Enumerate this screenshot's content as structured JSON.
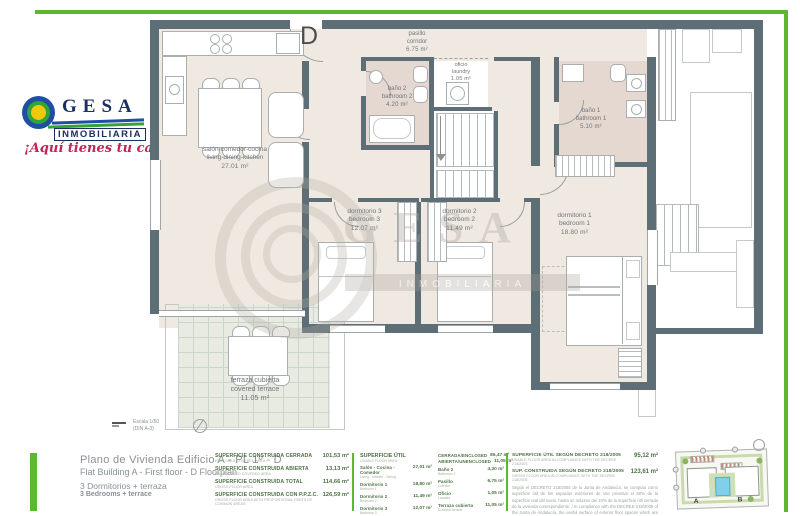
{
  "colors": {
    "green": "#5cb82e",
    "wall": "#5d6e76",
    "floor": "#efe9e1",
    "bath": "#e4d8d1",
    "navy": "#1c2f63",
    "tgreen": "#4d7245",
    "gray": "#8a9095"
  },
  "logo": {
    "name": "GESA",
    "sub": "INMOBILIARIA",
    "tagline": "¡Aquí tienes tu casa...!"
  },
  "entrance_label": "D",
  "watermark": {
    "line1": "GESA",
    "line2": "INMOBILIARIA"
  },
  "plan": {
    "rooms": [
      {
        "name_es": "salón-comedor-cocina",
        "name_en": "living-dining-kitchen",
        "area": "27.01 m²"
      },
      {
        "name_es": "pasillo",
        "name_en": "corridor",
        "area": "6.75 m²"
      },
      {
        "name_es": "oficio",
        "name_en": "laundry",
        "area": "1.05 m²"
      },
      {
        "name_es": "baño 2",
        "name_en": "bathroom 2",
        "area": "4.20 m²"
      },
      {
        "name_es": "baño 1",
        "name_en": "bathroom 1",
        "area": "5.10 m²"
      },
      {
        "name_es": "dormitorio 3",
        "name_en": "bedroom 3",
        "area": "12.07 m²"
      },
      {
        "name_es": "dormitorio 2",
        "name_en": "bedroom 2",
        "area": "11.49 m²"
      },
      {
        "name_es": "dormitorio 1",
        "name_en": "bedroom 1",
        "area": "18.80 m²"
      },
      {
        "name_es": "terraza cubierta",
        "name_en": "covered terrace",
        "area": "11.05 m²"
      }
    ],
    "scale": {
      "line1": "Escala 1/50",
      "line2": "(DIN A-3)"
    }
  },
  "title_block": {
    "line1": "Plano de Vivienda Edificio A - PL 1º - D",
    "line2": "Flat Building A - First floor - D  Floorplan",
    "line3": "3 Dormitorios + terraza",
    "line4": "3 Bedrooms + terrace"
  },
  "areas": {
    "built": [
      {
        "es": "SUPERFICIE CONSTRUIDA CERRADA",
        "en": "ENCLOSED COVERED AREA",
        "value": "101,53 m²"
      },
      {
        "es": "SUPERFICIE CONSTRUIDA ABIERTA",
        "en": "UNENCLOSED COVERED AREA",
        "value": "13,13 m²"
      },
      {
        "es": "SUPERFICIE CONSTRUIDA TOTAL",
        "en": "GROSS FLOOR AREA",
        "value": "114,66 m²"
      },
      {
        "es": "SUPERFICIE CONSTRUIDA CON P.P.Z.C.",
        "en": "GROSS FLOOR AREA WITH PROPORTIONAL PARTS OF COMMON AREAS",
        "value": "126,59 m²"
      }
    ],
    "useful": {
      "header_es": "SUPERFICIE ÚTIL",
      "header_en": "USABLE FLOOR AREA",
      "rows": [
        {
          "es": "Salón - Cocina - Comedor",
          "en": "Living - Kitchen - Dining",
          "value": "27,01 m²"
        },
        {
          "es": "Dormitorio 1",
          "en": "Bedroom 1",
          "value": "18,80 m²"
        },
        {
          "es": "Dormitorio 2",
          "en": "Bedroom 2",
          "value": "11,49 m²"
        },
        {
          "es": "Dormitorio 3",
          "en": "Bedroom 3",
          "value": "12,07 m²"
        },
        {
          "es": "Baño 1",
          "en": "Bathroom 1",
          "value": "5,10 m²"
        }
      ]
    },
    "useful_totals": [
      {
        "label": "CERRADA/ENCLOSED",
        "value": "86,47 m²"
      },
      {
        "label": "ABIERTA/UNENCLOSED",
        "value": "11,05 m²"
      }
    ],
    "useful2": [
      {
        "es": "Baño 2",
        "en": "Bathroom 2",
        "value": "4,20 m²"
      },
      {
        "es": "Pasillo",
        "en": "Corridor",
        "value": "6,75 m²"
      },
      {
        "es": "Oficio",
        "en": "Laundry",
        "value": "1,05 m²"
      },
      {
        "es": "Terraza cubierta",
        "en": "Covered terrace",
        "value": "11,05 m²"
      }
    ],
    "decree": {
      "row1_es": "SUPERFICIE ÚTIL SEGÚN DECRETO 218/2005",
      "row1_en": "USABLE FLOOR AREA IN COMPLIANCE WITH THE DECREE 218/2005",
      "row1_value": "95,12 m²",
      "row2_es": "SUP. CONSTRUIDA SEGÚN DECRETO 218/2005",
      "row2_en": "GROSS FLOOR AREA IN COMPLIANCE WITH THE DECREE 218/2005",
      "row2_value": "123,61 m²",
      "note_es": "Según el DECRETO 218/2005 de la Junta de Andalucía, se computa como superficie útil de los espacios exteriores de uso privativo el 50% de la superficie real del suelo, hasta un máximo del 10% de la superficie útil cerrada de la vivienda correspondiente. /",
      "note_en": " In compliance with the DECREE 218/2005 of the Junta de Andalucía, the useful surface of exterior floor spaces which are for the private use of the dwellings means 50% of the actual surface to a maximum of 10% of the useful enclosed surface."
    }
  },
  "keyplan": {
    "label_a": "A",
    "label_b": "B"
  }
}
